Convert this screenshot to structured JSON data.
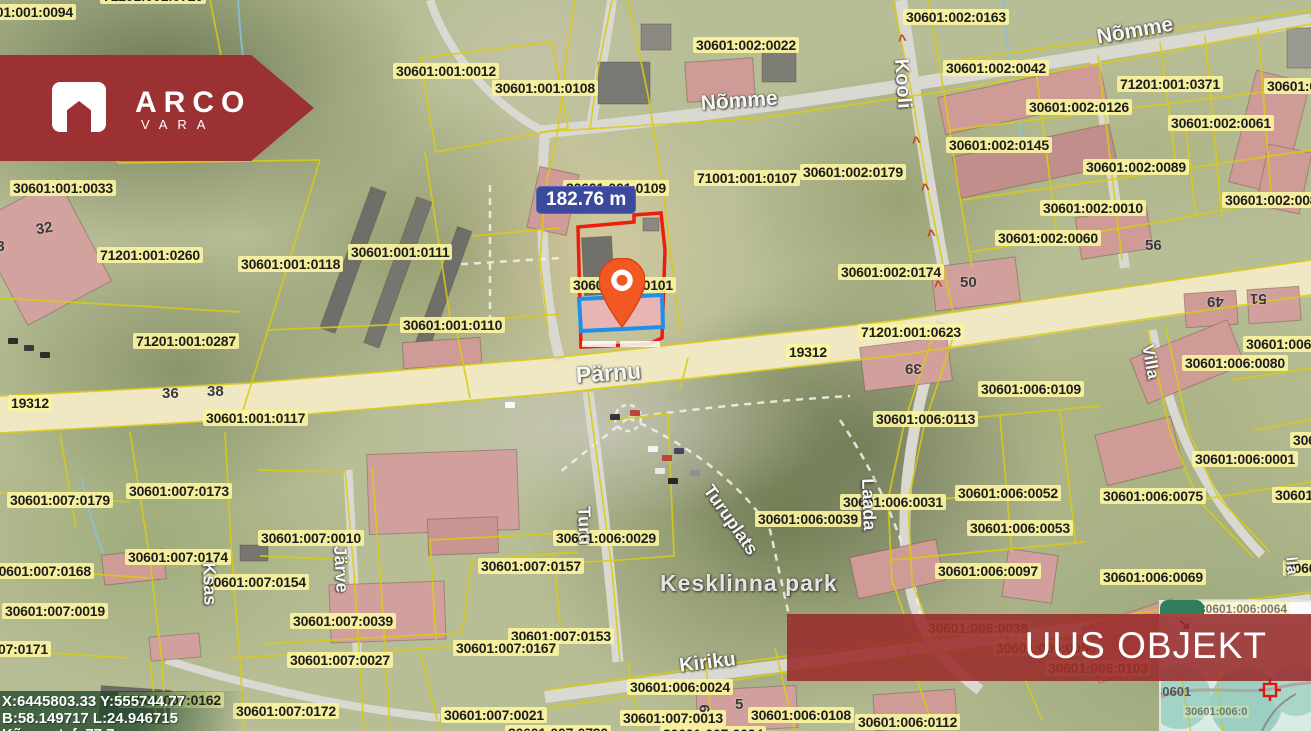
{
  "branding": {
    "logo_title": "ARCO",
    "logo_subtitle": "VARA"
  },
  "overlay_banner": {
    "label": "UUS OBJEKT"
  },
  "measurement_label": {
    "value": "182.76 m"
  },
  "coordinates_box": {
    "line1": "X:6445803.33 Y:555744.77",
    "line2": "B:58.149717 L:24.946715",
    "line3": "Kõrgus t. f. 77.7"
  },
  "minimap": {
    "collapse_arrow": "↘",
    "top_label": "30601:006:0064",
    "map_label_dark": "30601",
    "map_label_faint": "30601:006:0",
    "crosshair_icon": "target-crosshair"
  },
  "map": {
    "parcel_labels": [
      {
        "t": "30601:001:0094",
        "x": -30,
        "y": 4
      },
      {
        "t": "71201:001:0720",
        "x": 100,
        "y": -12
      },
      {
        "t": "30601:001:0012",
        "x": 393,
        "y": 63
      },
      {
        "t": "30601:001:0108",
        "x": 492,
        "y": 80
      },
      {
        "t": "30601:002:0022",
        "x": 693,
        "y": 37
      },
      {
        "t": "30601:002:0163",
        "x": 903,
        "y": 9
      },
      {
        "t": "30601:002:0042",
        "x": 943,
        "y": 60
      },
      {
        "t": "71201:001:0371",
        "x": 1117,
        "y": 76
      },
      {
        "t": "30601:0",
        "x": 1264,
        "y": 78
      },
      {
        "t": "30601:002:0126",
        "x": 1026,
        "y": 99
      },
      {
        "t": "30601:002:0061",
        "x": 1168,
        "y": 115
      },
      {
        "t": "30601:002:0145",
        "x": 946,
        "y": 137
      },
      {
        "t": "30601:002:0089",
        "x": 1083,
        "y": 159
      },
      {
        "t": "30601:002:0179",
        "x": 800,
        "y": 164
      },
      {
        "t": "30601:002:0010",
        "x": 1040,
        "y": 200
      },
      {
        "t": "30601:002:008",
        "x": 1222,
        "y": 192
      },
      {
        "t": "30601:002:0060",
        "x": 995,
        "y": 230
      },
      {
        "t": "30601:002:0174",
        "x": 838,
        "y": 264
      },
      {
        "t": "71201:001:0623",
        "x": 858,
        "y": 324
      },
      {
        "t": "30601:001:0033",
        "x": 10,
        "y": 180
      },
      {
        "t": "71201:001:0260",
        "x": 97,
        "y": 247
      },
      {
        "t": "30601:001:0118",
        "x": 238,
        "y": 256
      },
      {
        "t": "30601:001:0111",
        "x": 348,
        "y": 244
      },
      {
        "t": "71201:001:0287",
        "x": 133,
        "y": 333
      },
      {
        "t": "30601:001:0110",
        "x": 400,
        "y": 317
      },
      {
        "t": "30601:001:0109",
        "x": 563,
        "y": 180
      },
      {
        "t": "71001:001:0107",
        "x": 694,
        "y": 170
      },
      {
        "t": "30601:001:0101",
        "x": 570,
        "y": 277
      },
      {
        "t": "30601:001:0117",
        "x": 203,
        "y": 410
      },
      {
        "t": "19312",
        "x": 8,
        "y": 395
      },
      {
        "t": "19312",
        "x": 786,
        "y": 344
      },
      {
        "t": "30601:006:0",
        "x": 1243,
        "y": 336
      },
      {
        "t": "30601:006:0080",
        "x": 1182,
        "y": 355
      },
      {
        "t": "30601:006:0109",
        "x": 978,
        "y": 381
      },
      {
        "t": "30601:006:0113",
        "x": 873,
        "y": 411
      },
      {
        "t": "30601:0",
        "x": 1290,
        "y": 432
      },
      {
        "t": "30601:006:0001",
        "x": 1192,
        "y": 451
      },
      {
        "t": "30601:006:0052",
        "x": 955,
        "y": 485
      },
      {
        "t": "30601:006:0075",
        "x": 1100,
        "y": 488
      },
      {
        "t": "30601:006",
        "x": 1272,
        "y": 487
      },
      {
        "t": "30601:006:0031",
        "x": 840,
        "y": 494
      },
      {
        "t": "30601:006:0039",
        "x": 755,
        "y": 511
      },
      {
        "t": "30601:006:0053",
        "x": 967,
        "y": 520
      },
      {
        "t": "30601:007:0010",
        "x": 258,
        "y": 530
      },
      {
        "t": "30601:006:0029",
        "x": 553,
        "y": 530
      },
      {
        "t": "30601:007:0173",
        "x": 126,
        "y": 483
      },
      {
        "t": "30601:007:0179",
        "x": 7,
        "y": 492
      },
      {
        "t": "30601:007:0174",
        "x": 125,
        "y": 549
      },
      {
        "t": "30601:007:0157",
        "x": 478,
        "y": 558
      },
      {
        "t": "30601:007:0154",
        "x": 203,
        "y": 574
      },
      {
        "t": "30601:007:0168",
        "x": -12,
        "y": 563
      },
      {
        "t": "30601:006:0097",
        "x": 935,
        "y": 563
      },
      {
        "t": "30601:006:0069",
        "x": 1100,
        "y": 569
      },
      {
        "t": "30601:0",
        "x": 1283,
        "y": 560
      },
      {
        "t": "30601:007:0019",
        "x": 2,
        "y": 603
      },
      {
        "t": "30601:007:0039",
        "x": 290,
        "y": 613
      },
      {
        "t": "30601:007:0153",
        "x": 508,
        "y": 628
      },
      {
        "t": "30601:007:0167",
        "x": 453,
        "y": 640
      },
      {
        "t": "30601:007:0027",
        "x": 287,
        "y": 652
      },
      {
        "t": "30601:007:0171",
        "x": -55,
        "y": 641
      },
      {
        "t": "30601:006:0024",
        "x": 627,
        "y": 679
      },
      {
        "t": "30601:007:0162",
        "x": 118,
        "y": 692
      },
      {
        "t": "30601:007:0172",
        "x": 233,
        "y": 703
      },
      {
        "t": "30601:007:0021",
        "x": 441,
        "y": 707
      },
      {
        "t": "30601:007:0013",
        "x": 620,
        "y": 710
      },
      {
        "t": "30601:006:0108",
        "x": 748,
        "y": 707
      },
      {
        "t": "30601:006:0112",
        "x": 855,
        "y": 714
      },
      {
        "t": "30601:007:0730",
        "x": 505,
        "y": 725
      },
      {
        "t": "30601:007:0024",
        "x": 660,
        "y": 726
      },
      {
        "t": "30601:006:0038",
        "x": 925,
        "y": 620,
        "faint": true
      },
      {
        "t": "30601:006:0056",
        "x": 993,
        "y": 640,
        "faint": true
      },
      {
        "t": "30601:006:0103",
        "x": 1045,
        "y": 660,
        "faint": true
      },
      {
        "t": "30601:006:0064",
        "x": 1196,
        "y": 599,
        "faint": true
      }
    ],
    "street_labels": [
      {
        "t": "Nõmme",
        "x": 700,
        "y": 92,
        "r": -4,
        "s": 21
      },
      {
        "t": "Nõmme",
        "x": 1095,
        "y": 26,
        "r": -10,
        "s": 21
      },
      {
        "t": "Kooli",
        "x": 912,
        "y": 58,
        "r": 86,
        "s": 20
      },
      {
        "t": "Pärnu",
        "x": 575,
        "y": 362,
        "r": -4,
        "s": 23
      },
      {
        "t": "Turu",
        "x": 594,
        "y": 506,
        "r": 88,
        "s": 18
      },
      {
        "t": "Turuplats",
        "x": 716,
        "y": 481,
        "r": 55,
        "s": 18
      },
      {
        "t": "Järve",
        "x": 350,
        "y": 545,
        "r": 87,
        "s": 18
      },
      {
        "t": "Ksas",
        "x": 219,
        "y": 562,
        "r": 88,
        "s": 18
      },
      {
        "t": "Laada",
        "x": 878,
        "y": 478,
        "r": 88,
        "s": 18
      },
      {
        "t": "Villa",
        "x": 1157,
        "y": 343,
        "r": 80,
        "s": 17
      },
      {
        "t": "Kiriku",
        "x": 678,
        "y": 655,
        "r": -7,
        "s": 20
      },
      {
        "t": "lla",
        "x": 1299,
        "y": 556,
        "r": 85,
        "s": 16
      },
      {
        "t": "Kesklinna park",
        "x": 660,
        "y": 570,
        "r": 0,
        "s": 23,
        "park": true
      }
    ],
    "house_numbers": [
      {
        "t": "32",
        "x": 36,
        "y": 220,
        "r": -10
      },
      {
        "t": "53",
        "x": -12,
        "y": 238,
        "r": 0
      },
      {
        "t": "36",
        "x": 162,
        "y": 385,
        "r": 0
      },
      {
        "t": "38",
        "x": 207,
        "y": 383,
        "r": 0
      },
      {
        "t": "50",
        "x": 960,
        "y": 274,
        "r": 0
      },
      {
        "t": "56",
        "x": 1145,
        "y": 237,
        "r": 0
      },
      {
        "t": "39",
        "x": 905,
        "y": 360,
        "r": 180
      },
      {
        "t": "49",
        "x": 1207,
        "y": 293,
        "r": 180
      },
      {
        "t": "51",
        "x": 1250,
        "y": 290,
        "r": 180
      },
      {
        "t": "5",
        "x": 735,
        "y": 696,
        "r": 0
      },
      {
        "t": "6",
        "x": 700,
        "y": 700,
        "r": 90
      }
    ],
    "direction_arrows": [
      {
        "x": 898,
        "y": 32
      },
      {
        "x": 912,
        "y": 134
      },
      {
        "x": 921,
        "y": 181
      },
      {
        "x": 927,
        "y": 227
      },
      {
        "x": 934,
        "y": 278
      }
    ]
  },
  "colors": {
    "accent_red": "#9c3133",
    "marker_orange": "#f25822",
    "parcel_line_yellow": "#d9cb15",
    "label_bg": "#faf3a0",
    "highlight_red": "#ee1c0c",
    "highlight_blue": "#1f8fe8",
    "measure_bg": "#3b4a9d",
    "minimap_green": "#2f7e5b"
  }
}
